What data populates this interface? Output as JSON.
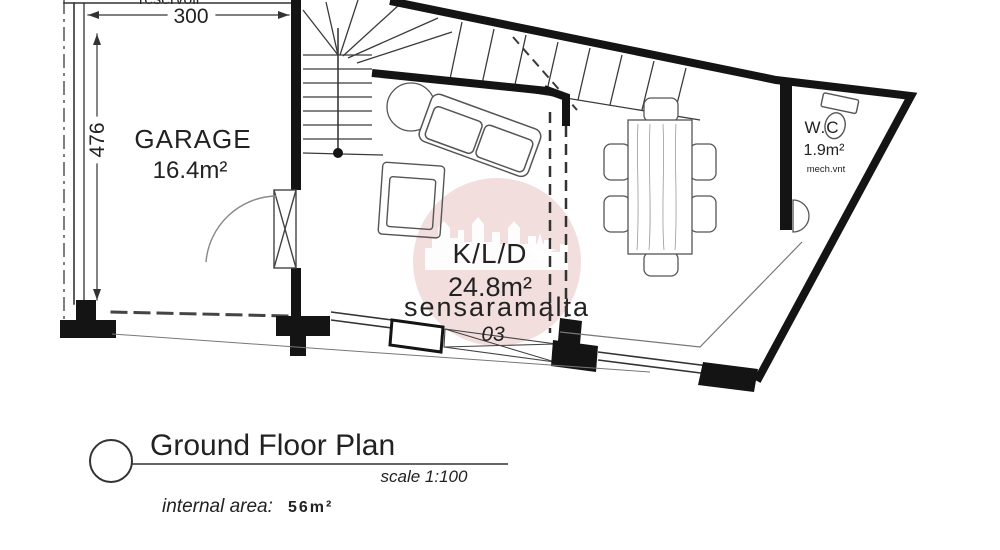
{
  "watermark": {
    "text": "sensaramalta",
    "circle_color": "#f3dede",
    "text_color": "#e4bebe"
  },
  "plan": {
    "top_clipped_label": "reservoir",
    "dimensions": {
      "width": "300",
      "height": "476"
    },
    "garage": {
      "label": "GARAGE",
      "area": "16.4m²"
    },
    "kld": {
      "label": "K/L/D",
      "area": "24.8m²",
      "room_number": "03"
    },
    "wc": {
      "label": "W.C",
      "area": "1.9m²",
      "vent": "mech.vnt"
    }
  },
  "legend": {
    "title": "Ground Floor Plan",
    "scale": "scale 1:100",
    "internal_area_label": "internal area:",
    "internal_area_value": "56m²",
    "area_color": "#c0392b"
  }
}
